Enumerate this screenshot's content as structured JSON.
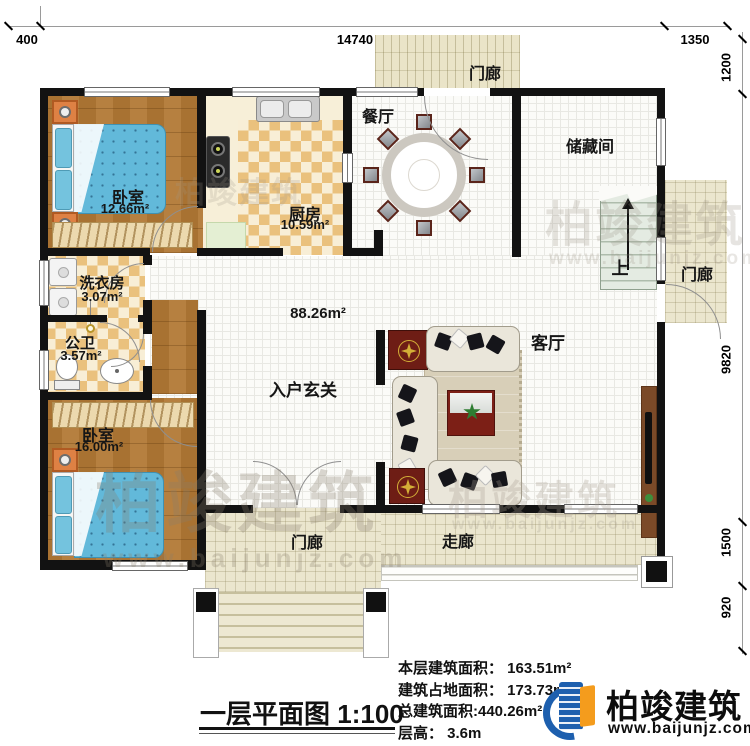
{
  "plan": {
    "title": "一层平面图",
    "scale": "1:100"
  },
  "dims": {
    "top": [
      "400",
      "14740",
      "1350"
    ],
    "right": [
      "1200",
      "9820",
      "1500",
      "920"
    ]
  },
  "rooms": {
    "bedroom1": {
      "label": "卧室",
      "area": "12.66m²"
    },
    "kitchen": {
      "label": "厨房",
      "area": "10.59m²"
    },
    "dining": {
      "label": "餐厅"
    },
    "porch_top": {
      "label": "门廊"
    },
    "storage": {
      "label": "储藏间"
    },
    "stairs_up": {
      "label": "上"
    },
    "porch_right": {
      "label": "门廊"
    },
    "laundry": {
      "label": "洗衣房",
      "area": "3.07m²"
    },
    "bath": {
      "label": "公卫",
      "area": "3.57m²"
    },
    "entry": {
      "label": "入户玄关",
      "area": "88.26m²"
    },
    "living": {
      "label": "客厅"
    },
    "bedroom2": {
      "label": "卧室",
      "area": "16.00m²"
    },
    "porch_bottom": {
      "label": "门廊"
    },
    "corridor": {
      "label": "走廊"
    }
  },
  "info": {
    "items": [
      {
        "label": "本层建筑面积： ",
        "value": "163.51m²"
      },
      {
        "label": "建筑占地面积： ",
        "value": "173.73m²"
      },
      {
        "label": "总建筑面积:",
        "value": "440.26m²"
      },
      {
        "label": "层高： ",
        "value": "3.6m"
      }
    ]
  },
  "logo": {
    "name": "柏竣建筑",
    "website": "www.baijunjz.com"
  },
  "watermark": {
    "text": "柏竣建筑",
    "website": "www.baijunjz.com"
  },
  "colors": {
    "wall": "#121212",
    "wood_floor": "#ab7634",
    "checker_tile": "#eac17d",
    "porch_floor": "#ebe6ce",
    "bed_blue": "#62b9da",
    "logo_blue": "#1d5fae",
    "logo_orange": "#f49c1d"
  }
}
